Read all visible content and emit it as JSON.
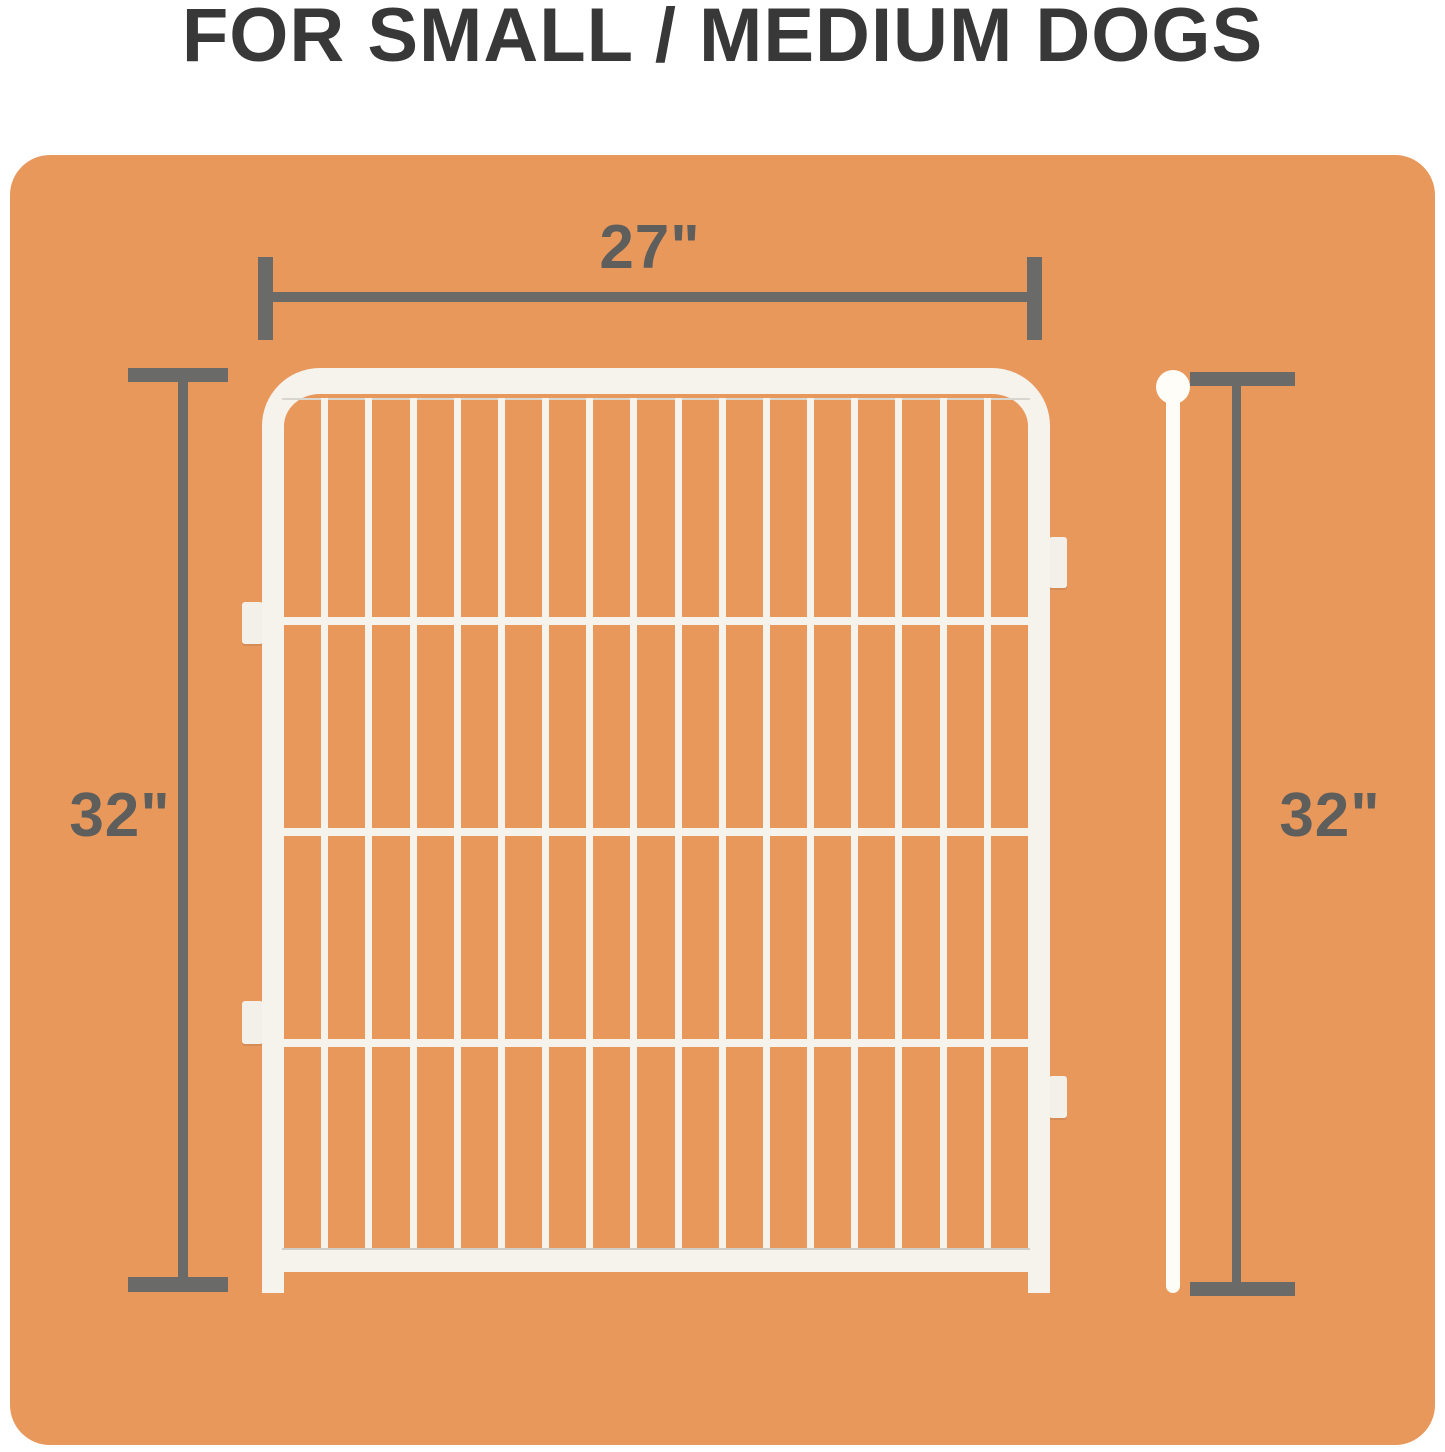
{
  "title": "FOR SMALL / MEDIUM DOGS",
  "dimensions": {
    "width_label": "27\"",
    "height_left_label": "32\"",
    "height_right_label": "32\""
  },
  "panel": {
    "description": "white wire pet playpen panel",
    "vertical_wire_count": 16,
    "horizontal_wire_count": 3
  },
  "colors": {
    "page_background": "#FFFFFF",
    "card_orange": "#E9985C",
    "dimension_gray": "#6A6A68",
    "title_gray": "#383838",
    "panel_white": "#F5F3EC",
    "rod_white": "#FDFCF6"
  }
}
